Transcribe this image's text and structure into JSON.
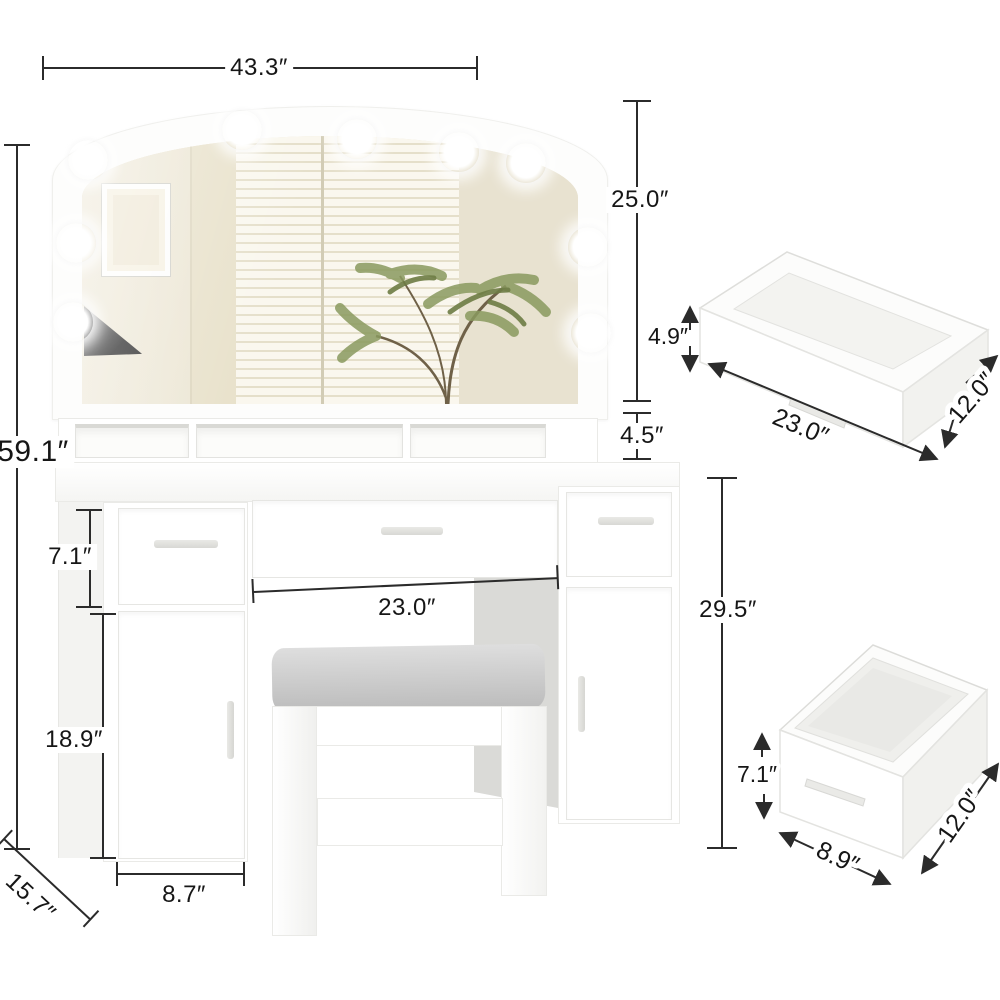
{
  "figure": {
    "kind": "furniture-dimension-diagram",
    "subject": "vanity desk with lighted mirror, storage hutch, cabinets and stool",
    "units": "inches"
  },
  "main_dimensions": {
    "overall_width": "43.3″",
    "overall_height": "59.1″",
    "mirror_height": "25.0″",
    "hutch_shelf_height": "4.5″",
    "drawer_front_height": "7.1″",
    "kneehole_width": "23.0″",
    "desk_height": "29.5″",
    "cabinet_door_height": "18.9″",
    "cabinet_width": "8.7″",
    "desk_depth": "15.7″"
  },
  "wide_drawer_detail": {
    "height": "4.9″",
    "width": "23.0″",
    "depth": "12.0″"
  },
  "deep_drawer_detail": {
    "height": "7.1″",
    "width": "8.9″",
    "depth": "12.0″"
  },
  "colors": {
    "background": "#ffffff",
    "dimension_line": "#2b2b2b",
    "label_text": "#161616",
    "furniture_white": "#ffffff",
    "edge_gray": "#e6e6e3",
    "mirror_wall_beige": "#ece6d4",
    "blinds_cream": "#faf7ee",
    "plant_green": "#8a9a5f",
    "cushion_gray": "#c9c9c9",
    "kneehole_shadow": "#d9d9d6"
  }
}
